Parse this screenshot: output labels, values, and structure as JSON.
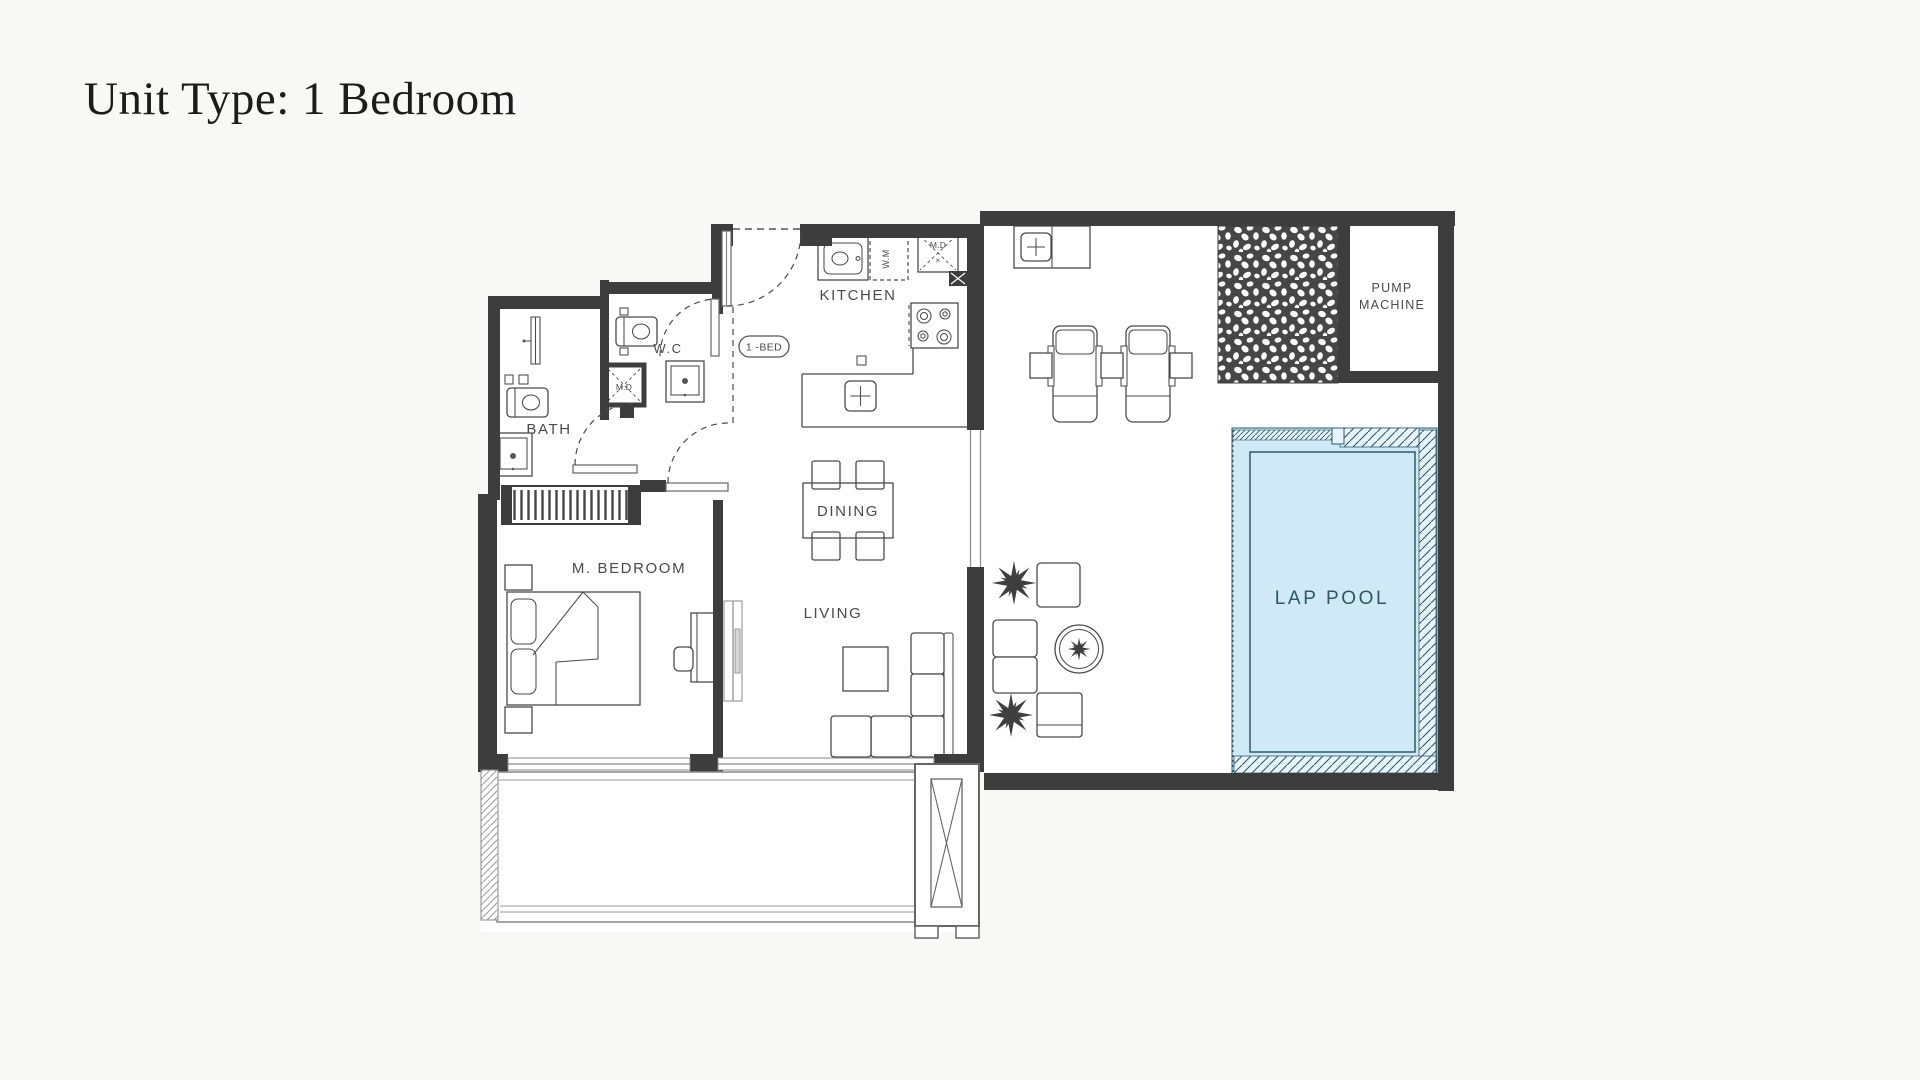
{
  "page": {
    "title": "Unit Type: 1 Bedroom"
  },
  "plan": {
    "rooms": {
      "kitchen": "KITCHEN",
      "wc": "W.C",
      "bath": "BATH",
      "bedroom": "M. BEDROOM",
      "dining": "DINING",
      "living": "LIVING",
      "lap_pool": "LAP POOL",
      "pump_line1": "PUMP",
      "pump_line2": "MACHINE"
    },
    "tags": {
      "unit_door": "1 -BED",
      "washing_machine": "W.M",
      "duct_kitchen": "M.D",
      "duct_kitchen_x": "×",
      "duct_wc": "M.D"
    },
    "colors": {
      "wall": "#3d3d3d",
      "line": "#4a4a4a",
      "label": "#4a4a4a",
      "pool_fill": "#cfe9f6",
      "pool_line": "#2d5a6b",
      "pool_text": "#2c5766",
      "bg": "#f8f8f6"
    }
  }
}
